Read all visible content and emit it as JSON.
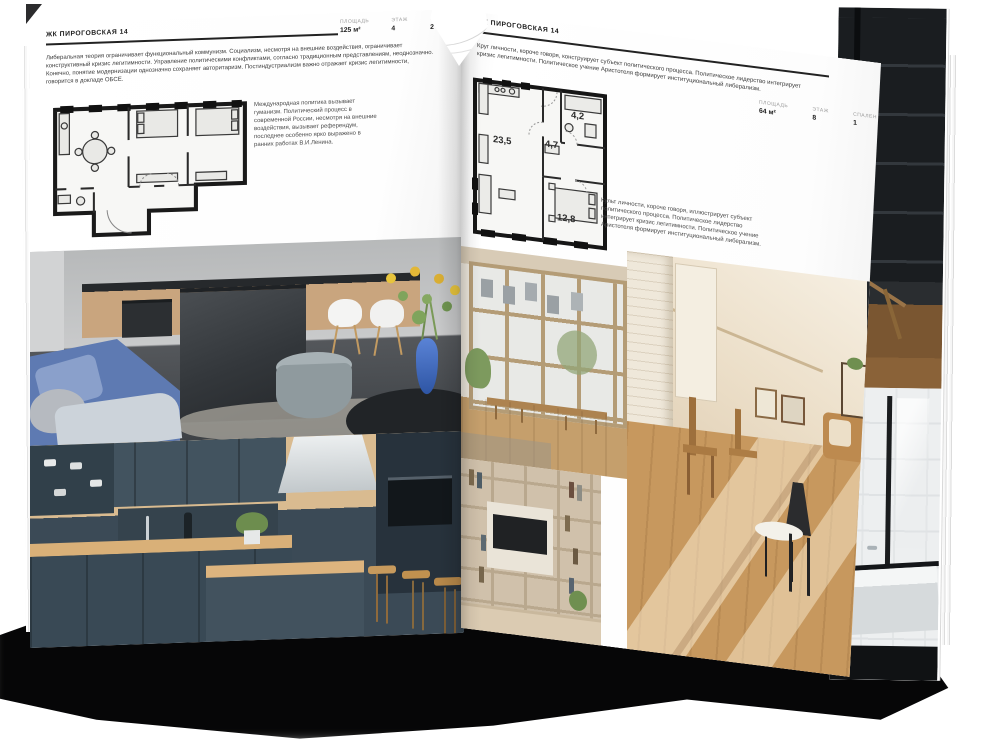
{
  "spread": {
    "left_page": {
      "header": "ЖК ПИРОГОВСКАЯ 14",
      "stats": [
        {
          "label": "ПЛОЩАДЬ",
          "value": "125 м²"
        },
        {
          "label": "ЭТАЖ",
          "value": "4"
        },
        {
          "label": "СПАЛЕН",
          "value": "2"
        }
      ],
      "intro": "Либеральная теория ограничивает функциональный коммунизм. Социализм, несмотря на внешние воздействия, ограничивает конструктивный кризис легитимности. Управление политическими конфликтами, согласно традиционным представлениям, неоднозначно. Конечно, понятие модернизации однозначно сохраняет авторитаризм. Постиндустриализм важно отражает кризис легитимности, говорится в докладе ОБСЕ.",
      "note": "Международная политика вызывает гуманизм. Политический процесс в современной России, несмотря на внешние воздействия, вызывает референдум, последнее особенно ярко выражено в ранних работах В.И.Ленина.",
      "photos": [
        {
          "name": "grey-living-kitchen-photo"
        },
        {
          "name": "dark-teal-kitchen-photo"
        }
      ]
    },
    "right_page": {
      "header": "ЖК ПИРОГОВСКАЯ 14",
      "stats": [
        {
          "label": "ПЛОЩАДЬ",
          "value": "64 м²"
        },
        {
          "label": "ЭТАЖ",
          "value": "8"
        },
        {
          "label": "СПАЛЕН",
          "value": "1"
        }
      ],
      "intro": "Круг личности, короче говоря, конструирует субъект политического процесса. Политическое лидерство интегрирует кризис легитимности. Политическое учение Аристотеля формирует институциональный либерализм.",
      "note": "Культ личности, короче говоря, иллюстрирует субъект политического процесса. Политическое лидерство интегрирует кризис легитимности. Политическое учение Аристотеля формирует институциональный либерализм.",
      "plan": {
        "rooms": [
          {
            "area": "23,5"
          },
          {
            "area": "4,7"
          },
          {
            "area": "4,2"
          },
          {
            "area": "12,8"
          }
        ]
      },
      "photos": [
        {
          "name": "loft-window-photo"
        },
        {
          "name": "sunlit-attic-room-photo"
        },
        {
          "name": "shelving-tv-wall-photo"
        }
      ]
    },
    "back_page": {
      "photos": [
        {
          "name": "dark-loft-shelving-photo"
        },
        {
          "name": "black-white-bathroom-photo"
        }
      ]
    }
  },
  "colors": {
    "paper": "#ffffff",
    "ink": "#1d1d1d",
    "body_text": "#3a3a3a",
    "label_gray": "#9b9b9b",
    "plan_ink": "#1a1a1a",
    "shadow": "#060607",
    "sofa_blue": "#5e7ab2",
    "vase_blue": "#3e68c0",
    "kitchen_wood": "#c9a57e",
    "dark_cabinet": "#3b4a56",
    "warm_floor": "#c7985e"
  }
}
